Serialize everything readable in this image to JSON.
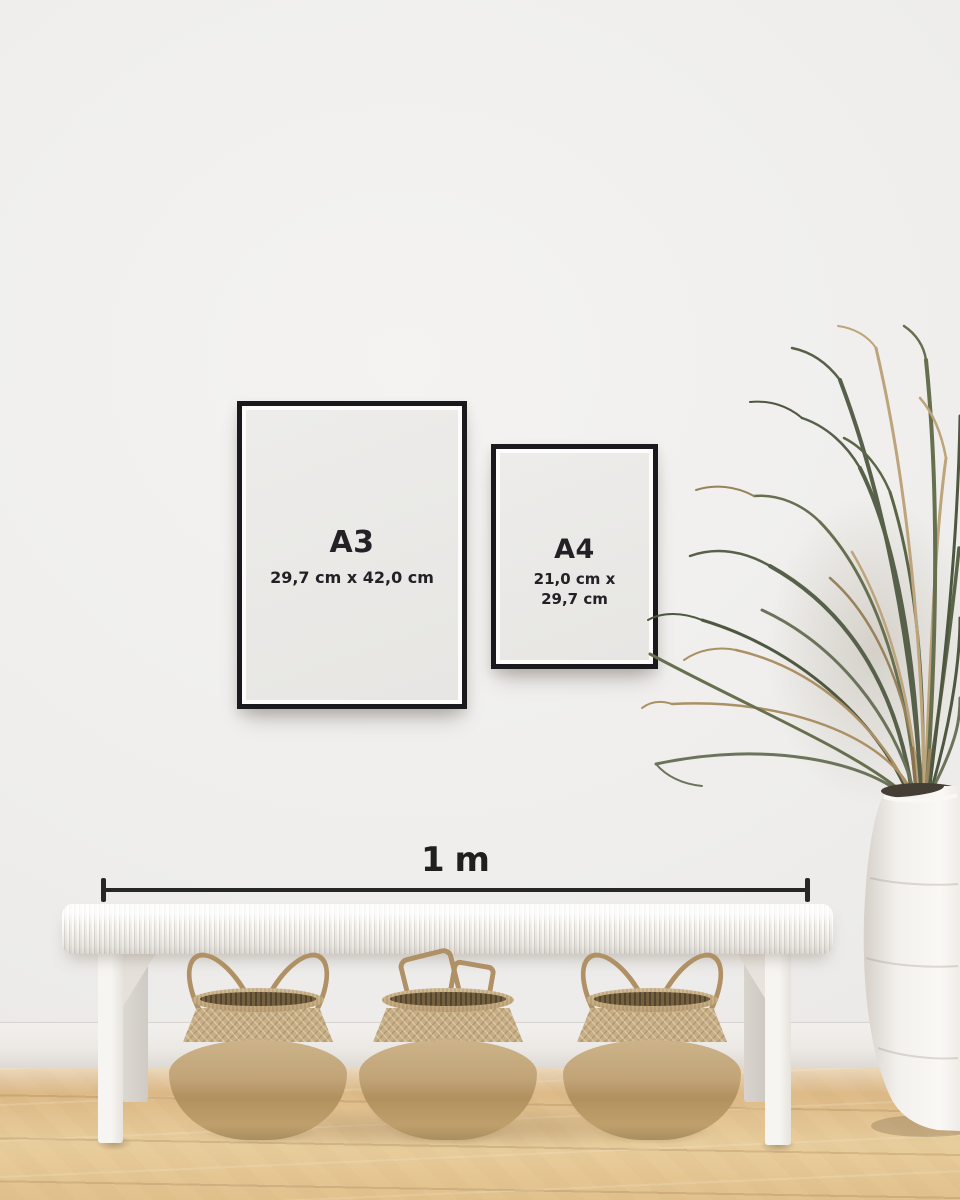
{
  "frames": [
    {
      "label": "A3",
      "dimensions": [
        "29,7 cm x 42,0 cm"
      ]
    },
    {
      "label": "A4",
      "dimensions": [
        "21,0 cm x",
        "29,7 cm"
      ]
    }
  ],
  "ruler": {
    "label": "1 m"
  },
  "scene": {
    "description": "White wall with two black poster frames (A3 and A4) above a white woven bench, three seagrass belly baskets, a white vase with a dried palm plant, on a light oak floor",
    "colors": {
      "wall": "#efeeec",
      "baseboard": "#ece9e5",
      "floor": "#e0bd8a",
      "frame_border": "#1a1a1e",
      "frame_paper": "#e9e8e5",
      "text": "#222226",
      "ruler": "#272727",
      "bench": "#f5f3ef",
      "basket": "#c3a87d",
      "vase": "#f3f1ed",
      "plant_green": "#5c6549",
      "plant_dried": "#ae9368"
    }
  }
}
